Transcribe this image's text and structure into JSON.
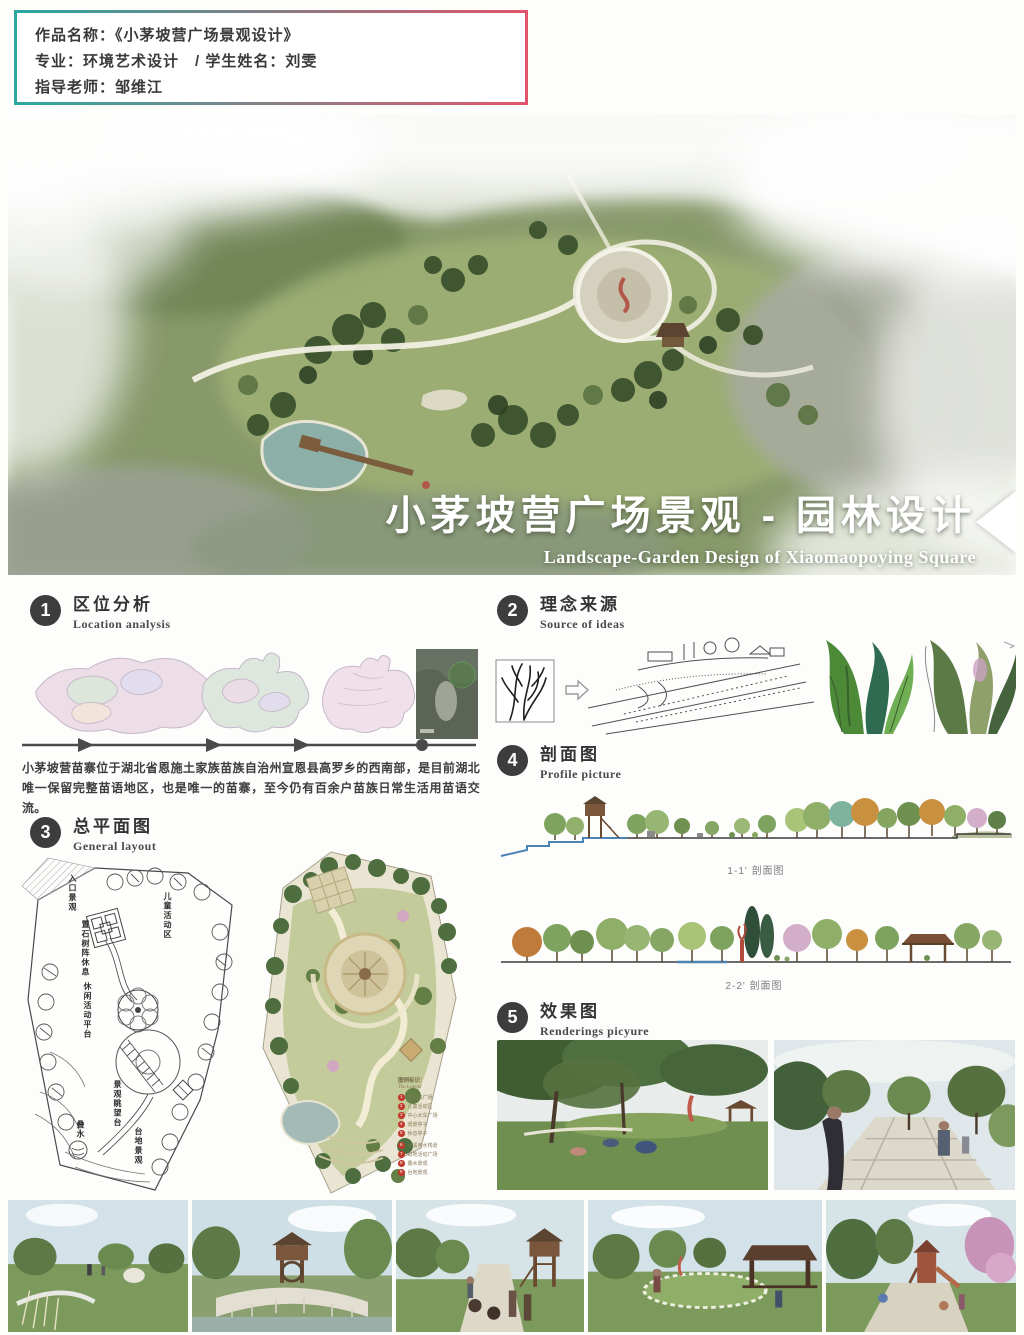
{
  "project_info": {
    "line1": "作品名称：《小茅坡营广场景观设计》",
    "line2": "专业：环境艺术设计　/ 学生姓名：刘雯",
    "line3": "指导老师：邹维江"
  },
  "hero": {
    "title_cn": "小茅坡营广场景观 - 园林设计",
    "title_en": "Landscape-Garden Design of Xiaomaopoying Square"
  },
  "sections": {
    "s1": {
      "num": "1",
      "title": "区位分析",
      "subtitle": "Location analysis"
    },
    "s2": {
      "num": "2",
      "title": "理念来源",
      "subtitle": "Source of ideas"
    },
    "s3": {
      "num": "3",
      "title": "总平面图",
      "subtitle": "General layout"
    },
    "s4": {
      "num": "4",
      "title": "剖面图",
      "subtitle": "Profile picture"
    },
    "s5": {
      "num": "5",
      "title": "效果图",
      "subtitle": "Renderings  picyure"
    }
  },
  "location_analysis": {
    "description": "小茅坡营苗寨位于湖北省恩施土家族苗族自治州宣恩县高罗乡的西南部，是目前湖北唯一保留完整苗语地区，也是唯一的苗寨，至今仍有百余户苗族日常生活用苗语交流。"
  },
  "sketch_plan": {
    "labels": [
      "入口景观",
      "儿童活动区",
      "置石树阵休息",
      "休闲活动平台",
      "景观眺望台",
      "叠水",
      "台地景观"
    ]
  },
  "legend": {
    "title_cn": "图例标识：",
    "title_en": "The Legend",
    "items": [
      {
        "num": "1",
        "label": "主入口广场"
      },
      {
        "num": "2",
        "label": "儿童活动区"
      },
      {
        "num": "3",
        "label": "中心水车广场"
      },
      {
        "num": "4",
        "label": "观景亭子"
      },
      {
        "num": "5",
        "label": "休息亭子"
      },
      {
        "num": "6",
        "label": "小溪亲水栈道"
      },
      {
        "num": "7",
        "label": "山地活动广场"
      },
      {
        "num": "8",
        "label": "叠水景观"
      },
      {
        "num": "9",
        "label": "台地景观"
      }
    ]
  },
  "profiles": {
    "section1_label": "1-1' 剖面图",
    "section2_label": "2-2' 剖面图"
  },
  "colors": {
    "accent_teal": "#2BA7A0",
    "accent_red": "#E0556B",
    "section_badge": "#3D3D3D",
    "legend_dot": "#C0392B"
  }
}
